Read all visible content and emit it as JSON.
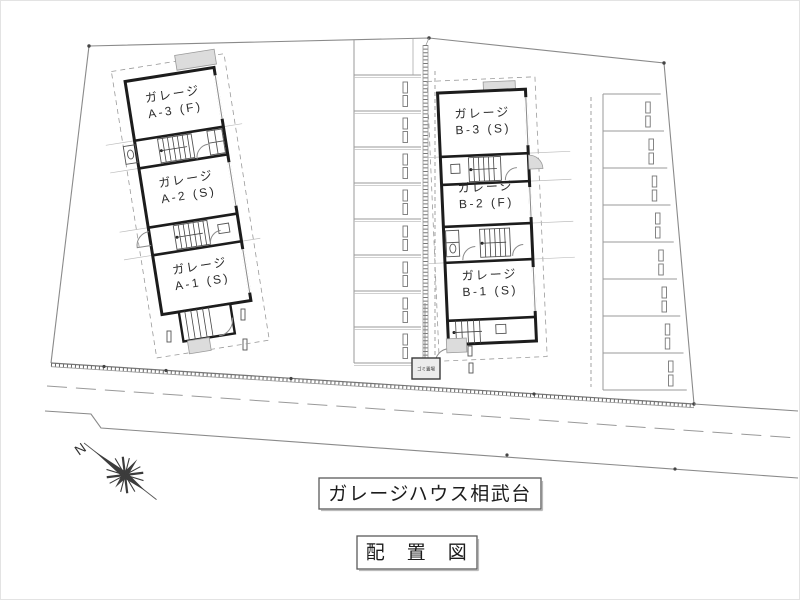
{
  "drawing": {
    "title": "ガレージハウス相武台",
    "subtitle": "配　置　図",
    "north_label": "N",
    "buildings": {
      "a": {
        "units": [
          {
            "line1": "ガレージ",
            "line2": "A-3 (F)"
          },
          {
            "line1": "ガレージ",
            "line2": "A-2 (S)"
          },
          {
            "line1": "ガレージ",
            "line2": "A-1 (S)"
          }
        ]
      },
      "b": {
        "units": [
          {
            "line1": "ガレージ",
            "line2": "B-3 (S)"
          },
          {
            "line1": "ガレージ",
            "line2": "B-2 (F)"
          },
          {
            "line1": "ガレージ",
            "line2": "B-1 (S)"
          }
        ]
      }
    },
    "site": {
      "trash_label": "ゴミ置場",
      "parking": {
        "middle_stalls": 8,
        "right_stalls": 8
      }
    },
    "colors": {
      "line": "#8a8a8a",
      "wall": "#1c1c1c",
      "gray_fill": "#dcdcdc",
      "background": "#ffffff"
    }
  }
}
